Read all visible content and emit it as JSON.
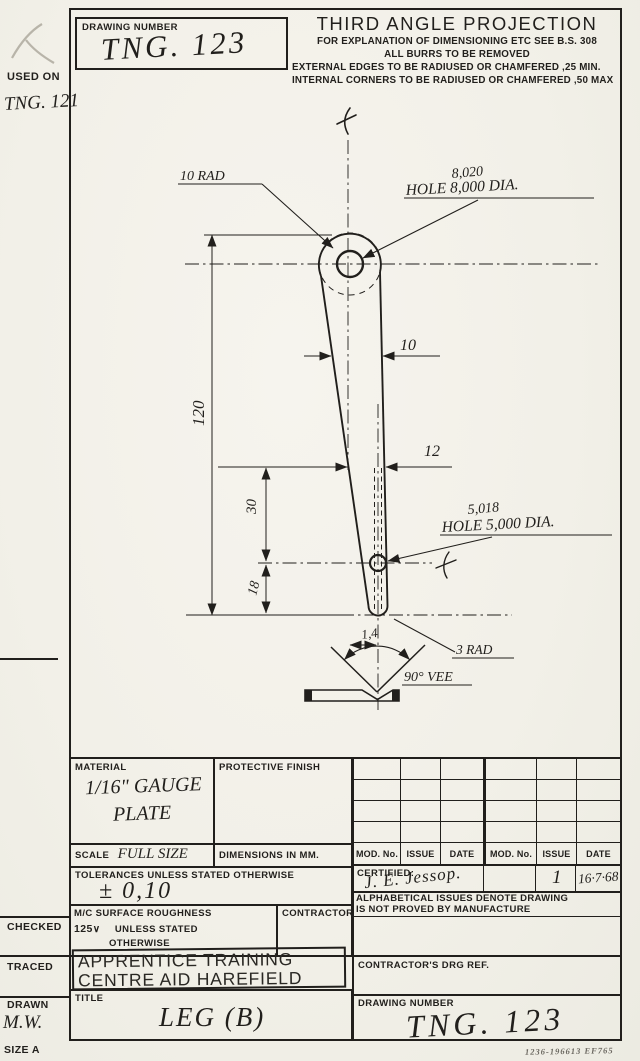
{
  "colors": {
    "paper": "#f3f1ea",
    "ink": "#211f1c"
  },
  "margin": {
    "used_on_label": "USED ON",
    "used_on_value": "TNG. 121",
    "checked_label": "CHECKED",
    "traced_label": "TRACED",
    "drawn_label": "DRAWN",
    "drawn_value": "M.W.",
    "size_label": "SIZE A"
  },
  "header": {
    "drawing_number_label": "DRAWING NUMBER",
    "drawing_number_value": "TNG. 123",
    "projection_title": "THIRD ANGLE PROJECTION",
    "notes": [
      "FOR EXPLANATION OF DIMENSIONING ETC SEE B.S. 308",
      "ALL BURRS TO BE REMOVED",
      "EXTERNAL EDGES TO BE RADIUSED OR CHAMFERED ,25 MIN.",
      "INTERNAL CORNERS TO BE RADIUSED OR CHAMFERED ,50 MAX"
    ]
  },
  "drawing": {
    "labels": {
      "length": "120",
      "upper_width": "10",
      "lower_width": "12",
      "hole_gap": "30",
      "tip_gap": "18",
      "vee_width": "1,4",
      "top_radius": "10 RAD",
      "top_hole_tol": "8,020",
      "top_hole": "HOLE 8,000 DIA.",
      "lower_hole_tol": "5,018",
      "lower_hole": "HOLE 5,000 DIA.",
      "tip_radius": "3 RAD",
      "vee_angle": "90° VEE"
    }
  },
  "tables": {
    "material_label": "MATERIAL",
    "material_value_line1": "1/16\" GAUGE",
    "material_value_line2": "PLATE",
    "protective_finish_label": "PROTECTIVE FINISH",
    "scale_label": "SCALE",
    "scale_value": "FULL SIZE",
    "dimensions_label": "DIMENSIONS IN MM.",
    "tolerances_label": "TOLERANCES UNLESS STATED OTHERWISE",
    "tolerances_value": "± 0,10",
    "mod_headers": [
      "MOD. No.",
      "ISSUE",
      "DATE",
      "MOD. No.",
      "ISSUE",
      "DATE"
    ],
    "certified_label": "CERTIFIED:",
    "certified_signature": "J. E. Jessop.",
    "issue_value": "1",
    "date_value": "16·7·68",
    "issues_note_line1": "ALPHABETICAL ISSUES DENOTE DRAWING",
    "issues_note_line2": "IS NOT PROVED BY MANUFACTURE",
    "surface_label_line1": "M/C SURFACE ROUGHNESS",
    "surface_roughness_value": "125",
    "surface_label_line2": "UNLESS STATED",
    "surface_label_line3": "OTHERWISE",
    "contractor_label": "CONTRACTOR",
    "stamp_line1": "APPRENTICE TRAINING",
    "stamp_line2": "CENTRE AID HAREFIELD",
    "title_label": "TITLE",
    "title_value": "LEG (B)",
    "contractors_ref_label": "CONTRACTOR'S DRG REF.",
    "drawing_number_label": "DRAWING NUMBER",
    "drawing_number_value": "TNG. 123"
  },
  "footer": {
    "stamp": "1236-196613 EF765"
  }
}
